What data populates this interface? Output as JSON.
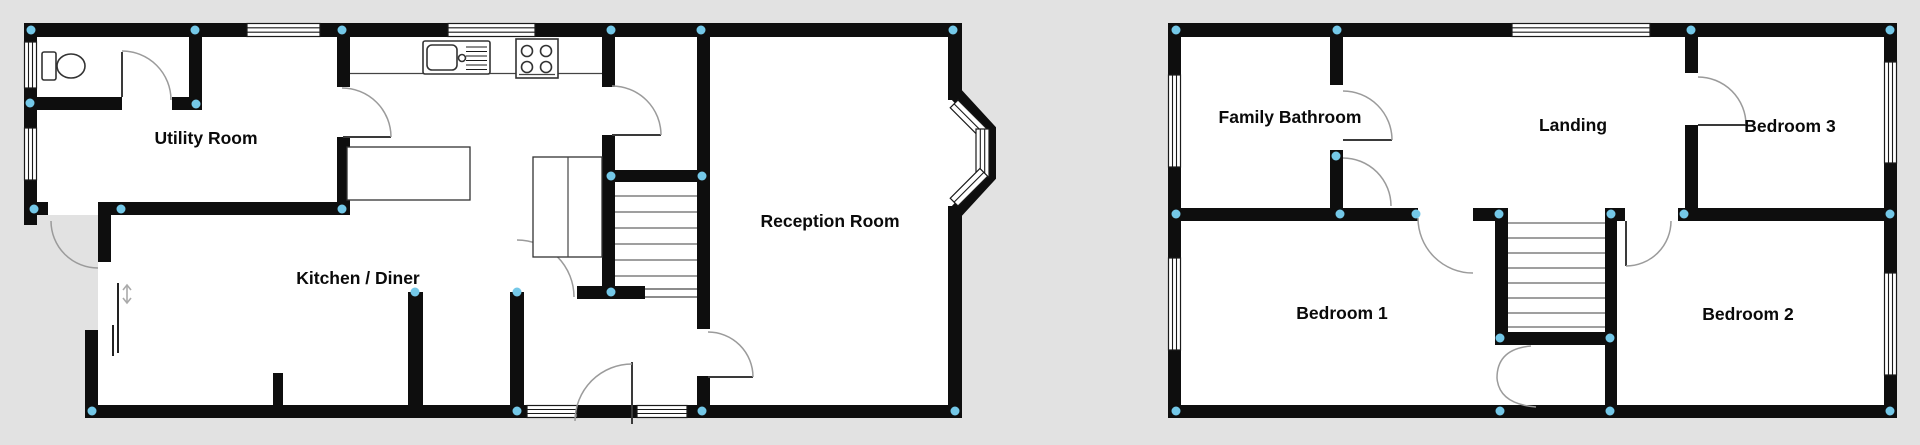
{
  "colors": {
    "background": "#e2e2e2",
    "wall": "#0e0e0e",
    "floor": "#ffffff",
    "junction_dot": "#74c8e8",
    "door_arc": "#9b9b9b",
    "fixture_outline": "#333333"
  },
  "ground_floor": {
    "rooms": [
      {
        "label": "Utility Room"
      },
      {
        "label": "Kitchen / Diner"
      },
      {
        "label": "Reception Room"
      }
    ],
    "fixtures": [
      {
        "icon": "toilet-icon"
      },
      {
        "icon": "kitchen-sink-icon"
      },
      {
        "icon": "hob-icon"
      },
      {
        "icon": "stairs-icon"
      },
      {
        "icon": "bay-window-icon"
      },
      {
        "icon": "door-swing-arc-icon"
      },
      {
        "icon": "opening-direction-arrow-icon"
      }
    ]
  },
  "first_floor": {
    "rooms": [
      {
        "label": "Family Bathroom"
      },
      {
        "label": "Landing"
      },
      {
        "label": "Bedroom 3"
      },
      {
        "label": "Bedroom 1"
      },
      {
        "label": "Bedroom 2"
      }
    ],
    "fixtures": [
      {
        "icon": "stairs-icon"
      },
      {
        "icon": "door-swing-arc-icon"
      }
    ]
  }
}
